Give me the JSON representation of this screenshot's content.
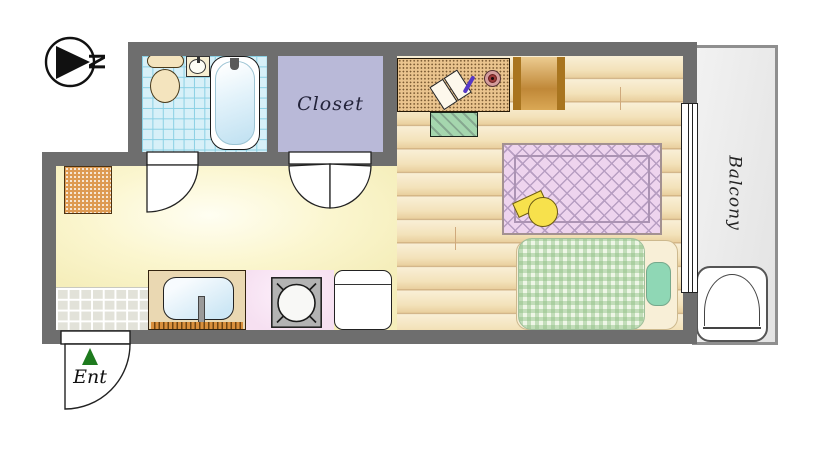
{
  "document_type": "studio apartment floor plan",
  "compass": {
    "label": "N"
  },
  "rooms": {
    "closet": {
      "label": "Closet"
    },
    "balcony": {
      "label": "Balcony"
    },
    "entrance": {
      "label": "Ent"
    }
  },
  "fixtures": {
    "bathroom": [
      "toilet",
      "hand-sink",
      "bathtub"
    ],
    "kitchen": [
      "shoe-cabinet",
      "kitchen-sink",
      "faucet",
      "gas-stove",
      "refrigerator"
    ],
    "living_room": [
      "desk",
      "open-book",
      "pen",
      "cup",
      "floor-chair",
      "dresser",
      "rug",
      "floor-cushion",
      "bed",
      "blanket",
      "pillow"
    ],
    "balcony": [
      "washing-machine"
    ],
    "openings": [
      "bathroom-door",
      "closet-double-door",
      "entrance-door",
      "window"
    ]
  },
  "colors": {
    "wall": "#6e6e6e",
    "kitchen_floor": "#fbf6cf",
    "wood_floor": "#f3e2ba",
    "bathroom_tile": "#d7f0f8",
    "closet_fill": "#b9b9d8",
    "balcony_fill": "#e9e9e9",
    "rug_fill": "#eed4ee",
    "blanket_fill": "#eef6e6",
    "cushion_yellow": "#f7e14c",
    "entrance_marker": "#1e7a1e"
  }
}
